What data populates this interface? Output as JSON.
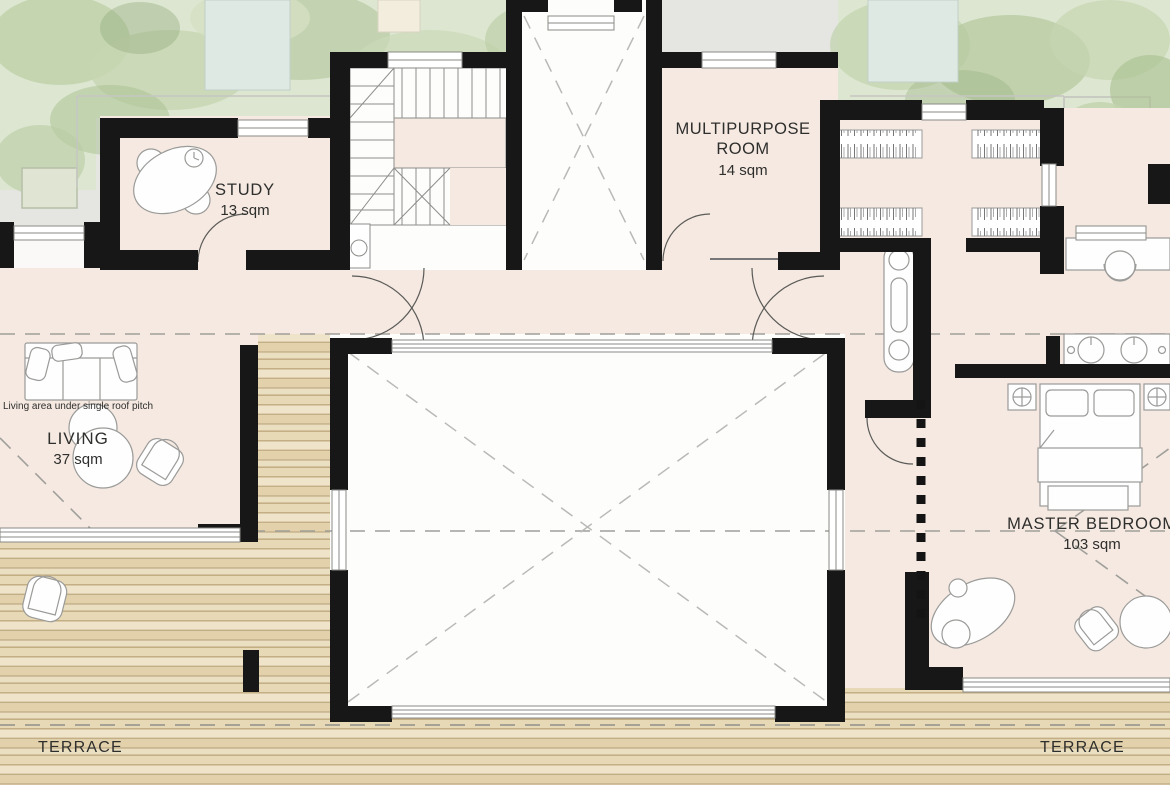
{
  "plan": {
    "kind": "floor-plan",
    "rooms": {
      "study": {
        "name": "STUDY",
        "area": "13 sqm"
      },
      "multipurpose": {
        "name_line1": "MULTIPURPOSE",
        "name_line2": "ROOM",
        "area": "14 sqm"
      },
      "living": {
        "name": "LIVING",
        "area": "37 sqm",
        "note": "Living area under single roof pitch"
      },
      "master_bedroom": {
        "name": "MASTER BEDROOM",
        "area": "103 sqm"
      },
      "terrace_left": {
        "name": "TERRACE"
      },
      "terrace_right": {
        "name": "TERRACE"
      }
    },
    "palette": {
      "wall": "#171717",
      "interior_floor": "#f5e9e2",
      "void_white": "#fdfdfc",
      "wood_deck": "#e7d8b6",
      "wood_gap": "#c4ae84",
      "exterior_paving": "#e5e5e2",
      "foliage": "#c7d6b2",
      "water": "#dfe9e4",
      "dash_line": "#a8a8a4",
      "furniture_stroke": "#9a9a98",
      "text": "#2e2e2c"
    }
  }
}
